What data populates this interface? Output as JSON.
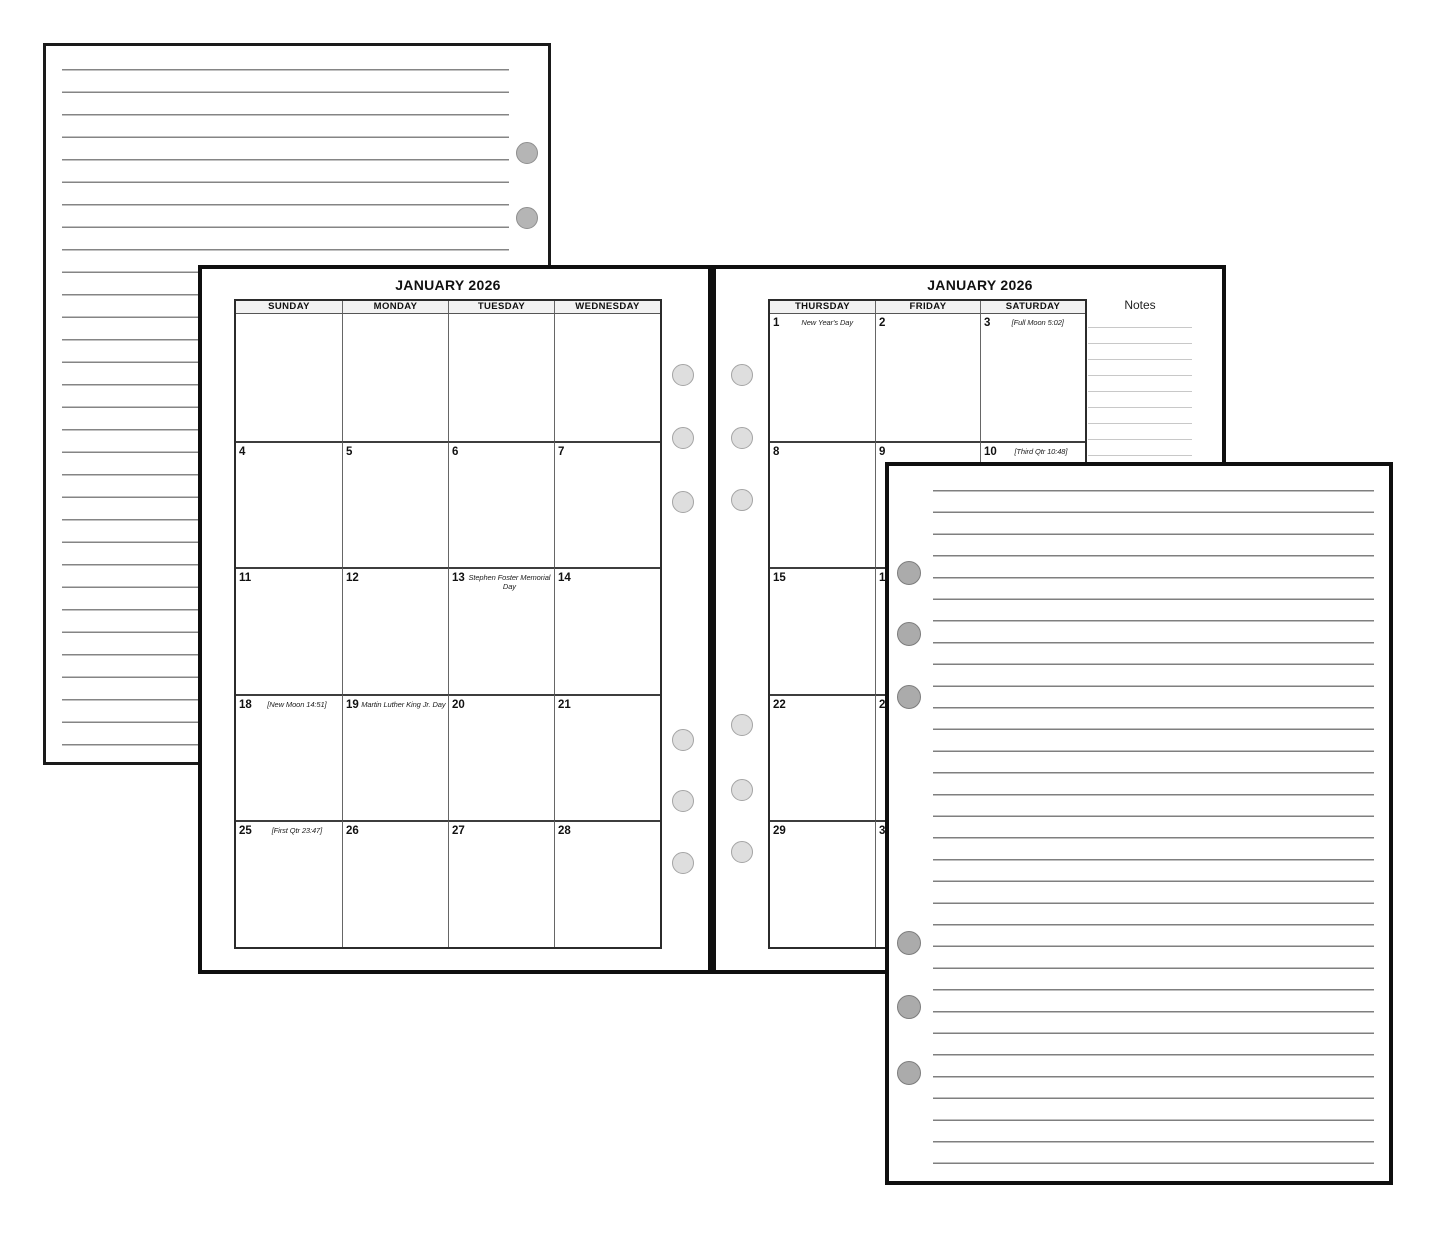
{
  "left_page": {
    "title": "JANUARY 2026",
    "day_headers": [
      "SUNDAY",
      "MONDAY",
      "TUESDAY",
      "WEDNESDAY"
    ],
    "weeks": [
      [
        {
          "date": "",
          "note": ""
        },
        {
          "date": "",
          "note": ""
        },
        {
          "date": "",
          "note": ""
        },
        {
          "date": "",
          "note": ""
        }
      ],
      [
        {
          "date": "4",
          "note": ""
        },
        {
          "date": "5",
          "note": ""
        },
        {
          "date": "6",
          "note": ""
        },
        {
          "date": "7",
          "note": ""
        }
      ],
      [
        {
          "date": "11",
          "note": ""
        },
        {
          "date": "12",
          "note": ""
        },
        {
          "date": "13",
          "note": "Stephen Foster Memorial Day"
        },
        {
          "date": "14",
          "note": ""
        }
      ],
      [
        {
          "date": "18",
          "note": "[New Moon 14:51]"
        },
        {
          "date": "19",
          "note": "Martin Luther King Jr. Day"
        },
        {
          "date": "20",
          "note": ""
        },
        {
          "date": "21",
          "note": ""
        }
      ],
      [
        {
          "date": "25",
          "note": "[First Qtr 23:47]"
        },
        {
          "date": "26",
          "note": ""
        },
        {
          "date": "27",
          "note": ""
        },
        {
          "date": "28",
          "note": ""
        }
      ]
    ]
  },
  "right_page": {
    "title": "JANUARY 2026",
    "notes_label": "Notes",
    "day_headers": [
      "THURSDAY",
      "FRIDAY",
      "SATURDAY"
    ],
    "weeks": [
      [
        {
          "date": "1",
          "note": "New Year's Day"
        },
        {
          "date": "2",
          "note": ""
        },
        {
          "date": "3",
          "note": "[Full Moon 5:02]"
        }
      ],
      [
        {
          "date": "8",
          "note": ""
        },
        {
          "date": "9",
          "note": ""
        },
        {
          "date": "10",
          "note": "[Third Qtr 10:48]"
        }
      ],
      [
        {
          "date": "15",
          "note": ""
        },
        {
          "date": "16",
          "note": ""
        },
        {
          "date": "",
          "note": ""
        }
      ],
      [
        {
          "date": "22",
          "note": ""
        },
        {
          "date": "23",
          "note": ""
        },
        {
          "date": "",
          "note": ""
        }
      ],
      [
        {
          "date": "29",
          "note": ""
        },
        {
          "date": "30",
          "note": ""
        },
        {
          "date": "",
          "note": ""
        }
      ]
    ]
  },
  "colors": {
    "page_border": "#0f0f0f",
    "rule_line": "#858585",
    "notes_rule_line": "#c8c8c8",
    "calendar_grid_line": "#3d3d3d",
    "header_fill": "#f2f2f2",
    "hole_light_gray": "#dedede",
    "hole_medium_gray": "#b5b5b5",
    "hole_dark_gray": "#ababab"
  }
}
